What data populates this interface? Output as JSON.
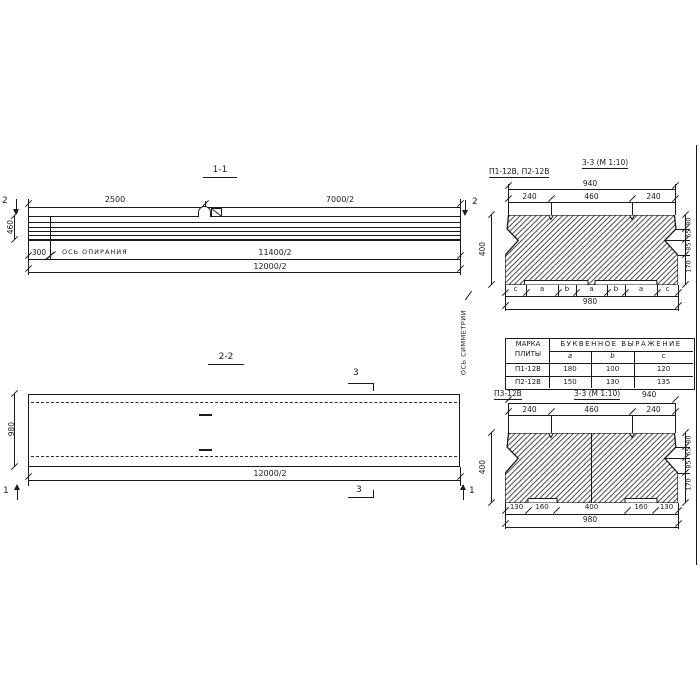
{
  "s11": {
    "title": "1-1",
    "dim_top_left": "2500",
    "dim_top_right": "7000/2",
    "section_mark": "2",
    "height": "460",
    "dim_support": "300",
    "support_axis_label": "ОСЬ ОПИРАНИЯ",
    "dim_mid": "11400/2",
    "dim_full": "12000/2"
  },
  "s22": {
    "title": "2-2",
    "height": "980",
    "dim_full": "12000/2",
    "section_mark_3": "3",
    "section_mark_1": "1"
  },
  "symmetry_axis_label": "ОСЬ СИММЕТРИИ",
  "sec_top": {
    "label": "П1-12В, П2-12В",
    "title": "3-3 (М 1:10)",
    "dim_overall_top": "940",
    "seg_left": "240",
    "seg_mid": "460",
    "seg_right": "240",
    "height": "400",
    "right_dims": [
      "80",
      "65",
      "85",
      "170"
    ],
    "letters": [
      "c",
      "a",
      "b",
      "a",
      "b",
      "a",
      "c"
    ],
    "dim_overall_bottom": "980"
  },
  "table": {
    "header_mark_line1": "МАРКА",
    "header_mark_line2": "ПЛИТЫ",
    "header_expression": "БУКВЕННОЕ ВЫРАЖЕНИЕ",
    "col_headers": [
      "a",
      "b",
      "c"
    ],
    "rows": [
      {
        "mark": "П1-12В",
        "a": "180",
        "b": "100",
        "c": "120"
      },
      {
        "mark": "П2-12В",
        "a": "150",
        "b": "130",
        "c": "135"
      }
    ]
  },
  "sec_bottom": {
    "label": "П3-12В",
    "title": "3-3 (М 1:10)",
    "dim_overall_top": "940",
    "seg_left": "240",
    "seg_mid": "460",
    "seg_right": "240",
    "height": "400",
    "right_dims": [
      "80",
      "65",
      "85",
      "170"
    ],
    "bottom_dims": [
      "130",
      "160",
      "400",
      "160",
      "130"
    ],
    "dim_overall_bottom": "980"
  }
}
